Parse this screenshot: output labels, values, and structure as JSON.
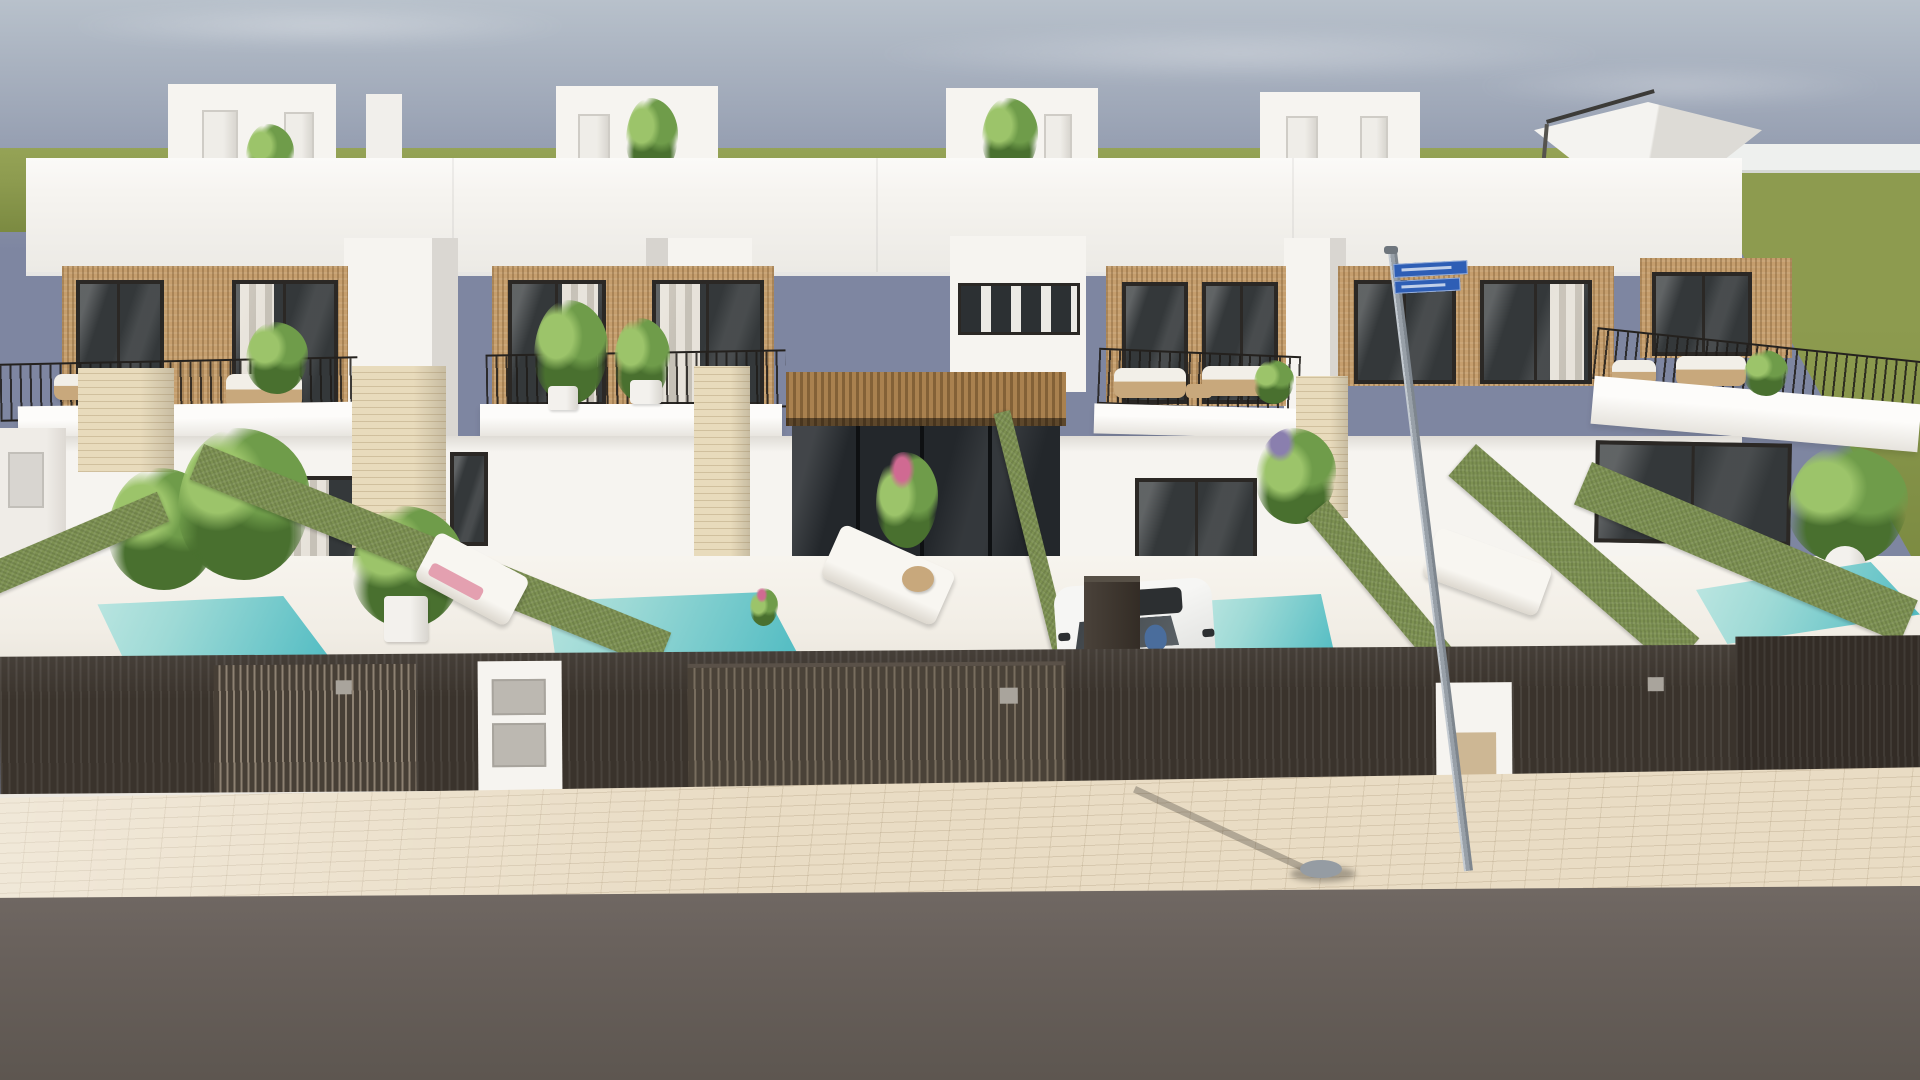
{
  "meta": {
    "kind": "3d-architectural-render",
    "description": "Street-front view of a row of four modern white two-storey townhouses with rooftop terraces, rattan-clad upper facades, balconies, private plunge pools, green hedge walls, dark slatted street fences, a parked white car, a street lamp with blue sign, beige paved sidewalk and asphalt road under a hazy sky over a green field horizon.",
    "width": 1920,
    "height": 1080
  },
  "palette": {
    "sky_top": "#b8c1cb",
    "sky_mid": "#98a1b3",
    "sky_low": "#7e86a1",
    "cloud": "#e8ecf2",
    "field": "#8d9b4f",
    "field_dark": "#7b8a41",
    "wall_lit": "#f6f4f0",
    "wall_mid": "#eceae5",
    "wall_shade": "#dcd9d4",
    "wall_deep": "#cac7c2",
    "rattan": "#c59e6d",
    "rattan_dark": "#a9814f",
    "frame": "#2b2825",
    "glass": "#34383a",
    "glass_hi": "#8b949b",
    "curtain": "#efe9df",
    "stone": "#e8dbbc",
    "stone_line": "#d3c19c",
    "hedge": "#7d9152",
    "hedge_dark": "#66783f",
    "pool": "#9edad6",
    "pool_deep": "#57bec4",
    "fence": "#3a332c",
    "fence_hi": "#4d453c",
    "gate_gap": "#93887a",
    "walk": "#efe8da",
    "terrace": "#f2eee6",
    "pave": "#e9dcc4",
    "pave_line": "#d6c5a8",
    "road": "#6a625d",
    "road_dark": "#57504b",
    "car_body": "#f3f3f1",
    "car_glass": "#3d4245",
    "pole": "#a7aeb6",
    "sign_blue": "#2e5eb5",
    "plant": "#6f9c4a",
    "plant_dark": "#49702f",
    "plant_light": "#9cc46a",
    "pot": "#f0eeea",
    "wicker": "#c8a87c",
    "towel_pink": "#e4a0b0",
    "accent_yellow": "#d8b34a"
  },
  "scene": {
    "houses": 4,
    "house_features": [
      "rooftop bulkhead with doors",
      "white parapet fascia",
      "rattan-clad upper window band",
      "balcony with thin black railing",
      "travertine stone pillar",
      "ground-floor sliding glass door",
      "white terrace"
    ],
    "pools": 4,
    "hedge_walls": 6,
    "sun_loungers": 3,
    "balcony_furniture": [
      "wicker chairs",
      "white outdoor sofas",
      "potted plants"
    ],
    "street": {
      "fences": "dark brown vertical-slat fences and gates with white masonry mailbox blocks",
      "sidewalk": "beige paver sidewalk",
      "road": "gray asphalt",
      "lamp_post": 1,
      "street_sign": {
        "plates": 2,
        "color": "blue",
        "text_legible": false
      }
    },
    "vehicles": [
      {
        "type": "car",
        "color": "white",
        "occupant": "driver visible",
        "location": "driveway of third house"
      }
    ],
    "rooftop_parasol": 1,
    "horizon": "flat green field",
    "sky": {
      "clouds": 3,
      "haze": true
    }
  }
}
